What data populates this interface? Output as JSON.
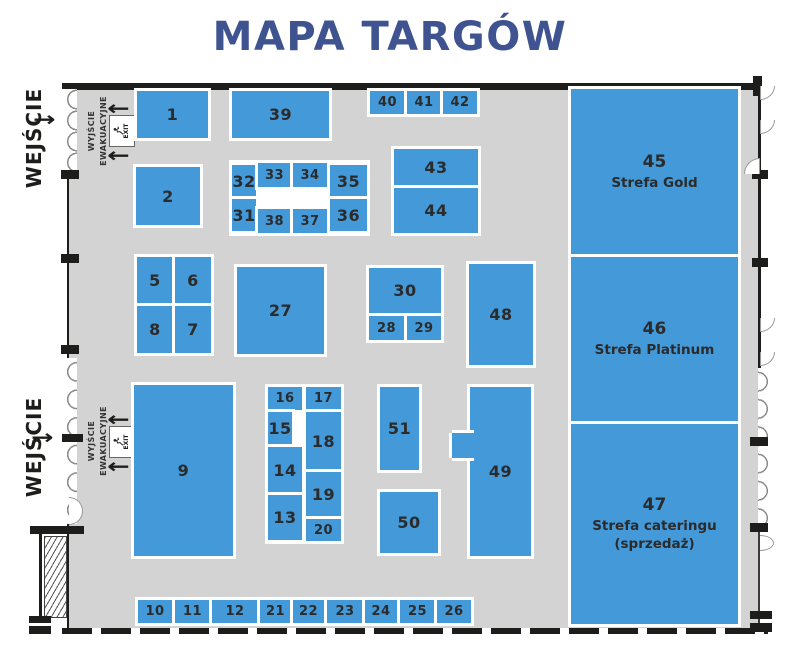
{
  "title": "MAPA TARGÓW",
  "colors": {
    "booth_blue": "#4499d9",
    "title_navy": "#3e5390",
    "hall_gray": "#d3d3d3",
    "wall_black": "#1d1d1b",
    "number_dark": "#2b2b2b"
  },
  "labels": {
    "entrance": "WEJŚCIE",
    "evac1": "WYJŚCIE",
    "evac2": "EWAKUACYJNE",
    "exit": "EXIT"
  },
  "booths": [
    {
      "label": "1",
      "x": 137,
      "y": 91,
      "w": 71,
      "h": 47
    },
    {
      "label": "39",
      "x": 232,
      "y": 91,
      "w": 97,
      "h": 47
    },
    {
      "label": "40",
      "x": 370,
      "y": 91,
      "w": 35,
      "h": 23
    },
    {
      "label": "41",
      "x": 407,
      "y": 91,
      "w": 34,
      "h": 23
    },
    {
      "label": "42",
      "x": 443,
      "y": 91,
      "w": 34,
      "h": 23
    },
    {
      "label": "43",
      "x": 394,
      "y": 149,
      "w": 84,
      "h": 37
    },
    {
      "label": "44",
      "x": 394,
      "y": 188,
      "w": 84,
      "h": 45
    },
    {
      "label": "2",
      "x": 136,
      "y": 167,
      "w": 64,
      "h": 58
    },
    {
      "label": "32",
      "x": 232,
      "y": 165,
      "w": 24,
      "h": 33
    },
    {
      "label": "33",
      "x": 258,
      "y": 163,
      "w": 33,
      "h": 24
    },
    {
      "label": "34",
      "x": 293,
      "y": 163,
      "w": 34,
      "h": 24
    },
    {
      "label": "35",
      "x": 330,
      "y": 165,
      "w": 37,
      "h": 33
    },
    {
      "label": "31",
      "x": 232,
      "y": 199,
      "w": 24,
      "h": 32
    },
    {
      "label": "38",
      "x": 258,
      "y": 209,
      "w": 33,
      "h": 24
    },
    {
      "label": "37",
      "x": 293,
      "y": 209,
      "w": 34,
      "h": 24
    },
    {
      "label": "36",
      "x": 330,
      "y": 199,
      "w": 37,
      "h": 32
    },
    {
      "label": "5",
      "x": 137,
      "y": 257,
      "w": 36,
      "h": 47
    },
    {
      "label": "6",
      "x": 175,
      "y": 257,
      "w": 36,
      "h": 47
    },
    {
      "label": "8",
      "x": 137,
      "y": 306,
      "w": 36,
      "h": 47
    },
    {
      "label": "7",
      "x": 175,
      "y": 306,
      "w": 36,
      "h": 47
    },
    {
      "label": "27",
      "x": 237,
      "y": 267,
      "w": 87,
      "h": 87
    },
    {
      "label": "30",
      "x": 369,
      "y": 268,
      "w": 72,
      "h": 45
    },
    {
      "label": "28",
      "x": 369,
      "y": 316,
      "w": 35,
      "h": 24
    },
    {
      "label": "29",
      "x": 407,
      "y": 316,
      "w": 34,
      "h": 24
    },
    {
      "label": "48",
      "x": 469,
      "y": 264,
      "w": 64,
      "h": 101
    },
    {
      "label": "9",
      "x": 134,
      "y": 385,
      "w": 99,
      "h": 171
    },
    {
      "label": "16",
      "x": 268,
      "y": 387,
      "w": 34,
      "h": 23
    },
    {
      "label": "17",
      "x": 306,
      "y": 387,
      "w": 35,
      "h": 23
    },
    {
      "label": "15",
      "x": 268,
      "y": 412,
      "w": 24,
      "h": 33
    },
    {
      "label": "18",
      "x": 306,
      "y": 412,
      "w": 35,
      "h": 58
    },
    {
      "label": "14",
      "x": 268,
      "y": 447,
      "w": 34,
      "h": 46
    },
    {
      "label": "19",
      "x": 306,
      "y": 472,
      "w": 35,
      "h": 45
    },
    {
      "label": "13",
      "x": 268,
      "y": 495,
      "w": 34,
      "h": 45
    },
    {
      "label": "20",
      "x": 306,
      "y": 519,
      "w": 35,
      "h": 22
    },
    {
      "label": "51",
      "x": 380,
      "y": 387,
      "w": 39,
      "h": 83
    },
    {
      "label": "50",
      "x": 380,
      "y": 492,
      "w": 58,
      "h": 61
    },
    {
      "label": "49",
      "x": 470,
      "y": 387,
      "w": 61,
      "h": 169
    },
    {
      "label": "",
      "x": 452,
      "y": 433,
      "w": 22,
      "h": 25,
      "cls": "tab"
    },
    {
      "label": "10",
      "x": 138,
      "y": 600,
      "w": 34,
      "h": 23
    },
    {
      "label": "11",
      "x": 175,
      "y": 600,
      "w": 35,
      "h": 23
    },
    {
      "label": "12",
      "x": 212,
      "y": 600,
      "w": 46,
      "h": 23
    },
    {
      "label": "21",
      "x": 260,
      "y": 600,
      "w": 31,
      "h": 23
    },
    {
      "label": "22",
      "x": 293,
      "y": 600,
      "w": 31,
      "h": 23
    },
    {
      "label": "23",
      "x": 327,
      "y": 600,
      "w": 36,
      "h": 23
    },
    {
      "label": "24",
      "x": 365,
      "y": 600,
      "w": 32,
      "h": 23
    },
    {
      "label": "25",
      "x": 400,
      "y": 600,
      "w": 35,
      "h": 23
    },
    {
      "label": "26",
      "x": 437,
      "y": 600,
      "w": 34,
      "h": 23
    }
  ],
  "zones": [
    {
      "number": "45",
      "name": "Strefa Gold",
      "x": 571,
      "y": 89,
      "w": 167,
      "h": 165
    },
    {
      "number": "46",
      "name": "Strefa Platinum",
      "x": 571,
      "y": 257,
      "w": 167,
      "h": 164
    },
    {
      "number": "47",
      "name": "Strefa cateringu",
      "subname": "(sprzedaż)",
      "x": 571,
      "y": 424,
      "w": 167,
      "h": 200
    }
  ]
}
